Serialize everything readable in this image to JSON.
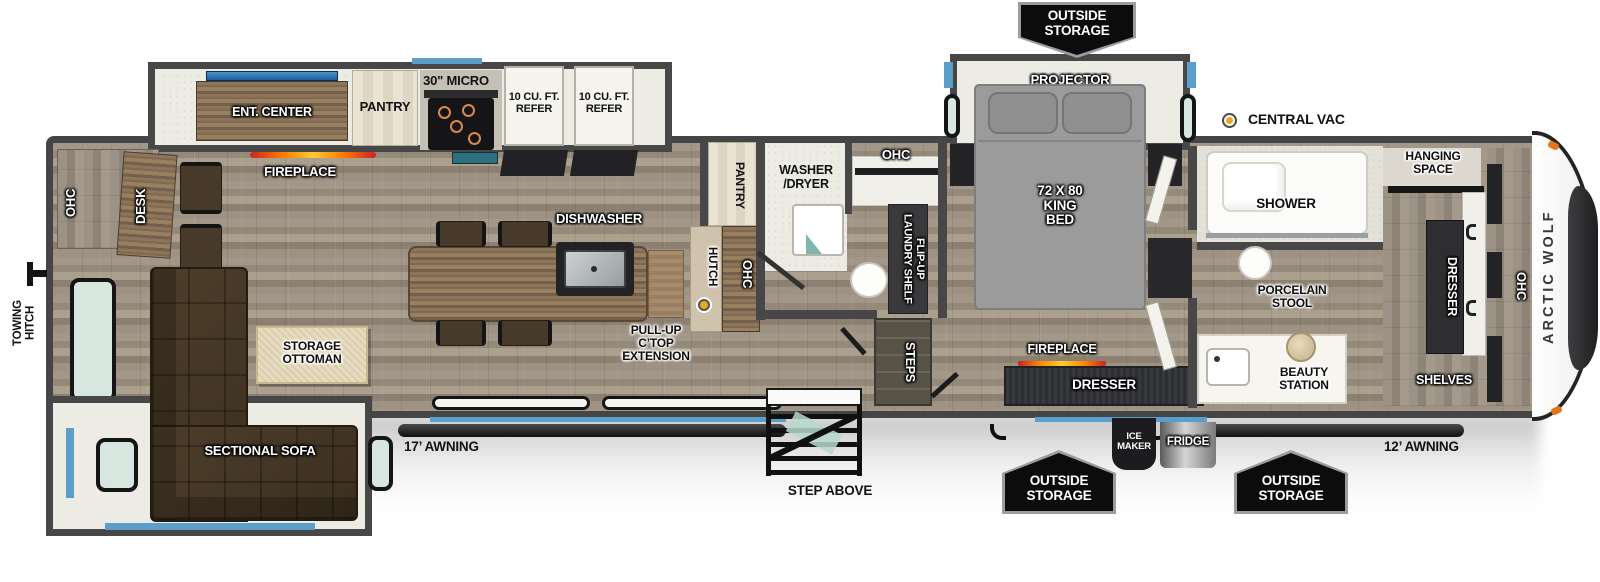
{
  "brand": "ARCTIC WOLF",
  "exterior": {
    "towing_hitch": "TOWING\nHITCH",
    "awning_rear": "17’ AWNING",
    "awning_front": "12’ AWNING",
    "outside_storage": "OUTSIDE\nSTORAGE",
    "step_above": "STEP ABOVE",
    "ice_maker": "ICE\nMAKER",
    "fridge": "FRIDGE",
    "central_vac": "CENTRAL VAC"
  },
  "living": {
    "ohc_rear": "OHC",
    "desk": "DESK",
    "ent_center": "ENT. CENTER",
    "fireplace": "FIREPLACE",
    "pantry": "PANTRY",
    "micro": "30\" MICRO",
    "refer": "10 CU. FT.\nREFER",
    "dishwasher": "DISHWASHER",
    "pull_up": "PULL-UP\nC’TOP\nEXTENSION",
    "storage_ottoman": "STORAGE\nOTTOMAN",
    "sectional_sofa": "SECTIONAL SOFA",
    "pantry2": "PANTRY",
    "hutch": "HUTCH",
    "ohc_hutch": "OHC"
  },
  "bath": {
    "washer_dryer": "WASHER\n/DRYER",
    "ohc": "OHC",
    "flip_up_shelf": "FLIP-UP\nLAUNDRY SHELF",
    "steps": "STEPS"
  },
  "bedroom": {
    "projector": "PROJECTOR",
    "king_bed": "72 X 80\nKING\nBED",
    "fireplace": "FIREPLACE",
    "dresser": "DRESSER"
  },
  "front_bath": {
    "shower": "SHOWER",
    "porcelain_stool": "PORCELAIN\nSTOOL",
    "beauty_station": "BEAUTY\nSTATION"
  },
  "front_closet": {
    "hanging_space": "HANGING\nSPACE",
    "dresser": "DRESSER",
    "ohc": "OHC",
    "shelves": "SHELVES"
  },
  "colors": {
    "accent_blue": "#5b9ec9",
    "marker_yellow": "#eca61f",
    "banner_black": "#0c0c0c",
    "wall_gray": "#474747"
  }
}
